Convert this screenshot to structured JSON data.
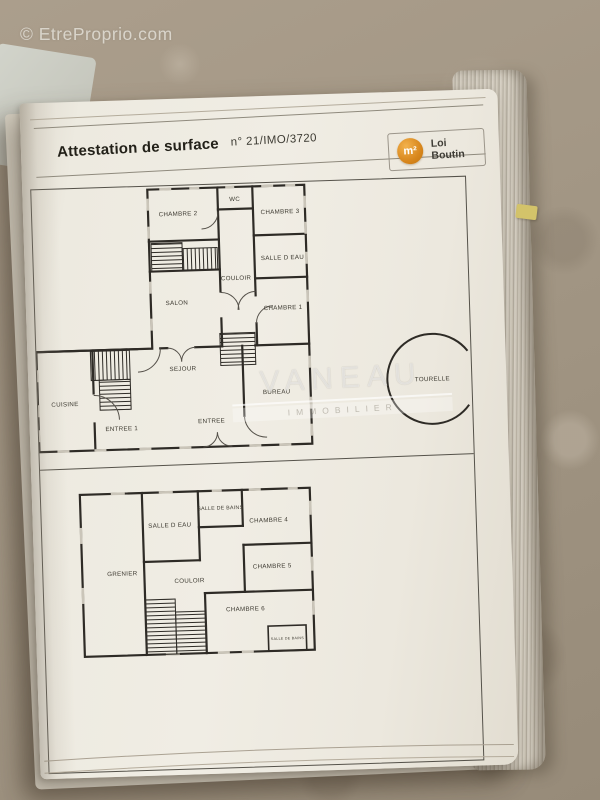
{
  "photo": {
    "site_watermark": "© EtreProprio.com"
  },
  "document": {
    "title": "Attestation de surface",
    "reference": "n° 21/IMO/3720",
    "logo": {
      "symbol": "m²",
      "line1": "Loi",
      "line2": "Boutin",
      "circle_color": "#d8871d"
    },
    "agency": {
      "name": "VANEAU",
      "tagline": "IMMOBILIER"
    },
    "floor_plans": {
      "upper": {
        "rooms": [
          "CHAMBRE 2",
          "WC",
          "CHAMBRE 3",
          "SALLE D EAU",
          "COULOIR",
          "SALON",
          "CHAMBRE 1",
          "SEJOUR",
          "CUISINE",
          "ENTREE 1",
          "ENTREE",
          "BUREAU",
          "TOURELLE"
        ]
      },
      "lower": {
        "rooms": [
          "GRENIER",
          "SALLE D EAU",
          "SALLE DE BAINS",
          "CHAMBRE 4",
          "CHAMBRE 5",
          "COULOIR",
          "CHAMBRE 6",
          "SALLE DE BAINS"
        ]
      }
    }
  }
}
